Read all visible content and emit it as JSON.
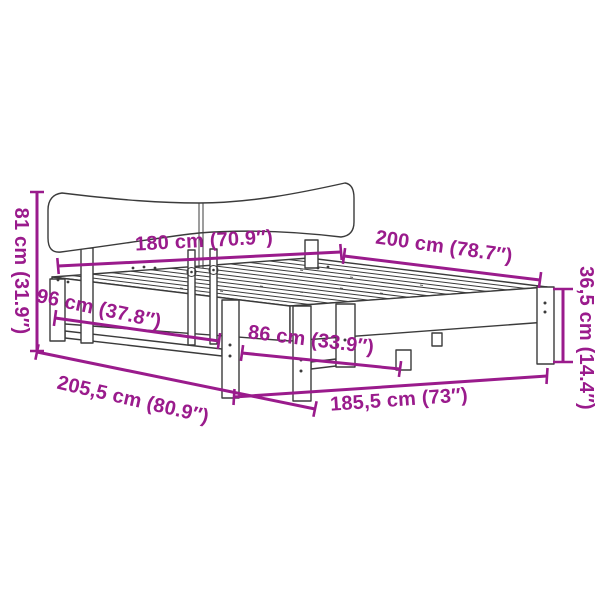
{
  "diagram": {
    "type": "product-dimension-diagram",
    "subject": "wooden bed frame with curved headboard and slatted base, drawn in perspective line art",
    "colors": {
      "annotation": "#9A1B8C",
      "line_art": "#3B3B3B",
      "background": "#FFFFFF"
    },
    "dimension_labels": [
      {
        "position": "left-vertical",
        "measures": "headboard-height",
        "text": "81 cm (31.9″)"
      },
      {
        "position": "upper-center-horizontal",
        "measures": "headboard-width",
        "text": "180 cm (70.9″)"
      },
      {
        "position": "upper-right-diagonal",
        "measures": "bed-length-top",
        "text": "200 cm (78.7″)"
      },
      {
        "position": "right-vertical",
        "measures": "side-rail-height",
        "text": "36,5 cm (14.4″)"
      },
      {
        "position": "mid-left-diagonal",
        "measures": "frame-height-at-head",
        "text": "96 cm (37.8″)"
      },
      {
        "position": "center-diagonal",
        "measures": "clearance-between-legs",
        "text": "86 cm (33.9″)"
      },
      {
        "position": "bottom-left-diagonal",
        "measures": "frame-outer-length",
        "text": "205,5 cm (80.9″)"
      },
      {
        "position": "bottom-right-horizontal",
        "measures": "frame-outer-width",
        "text": "185,5 cm (73″)"
      }
    ]
  }
}
